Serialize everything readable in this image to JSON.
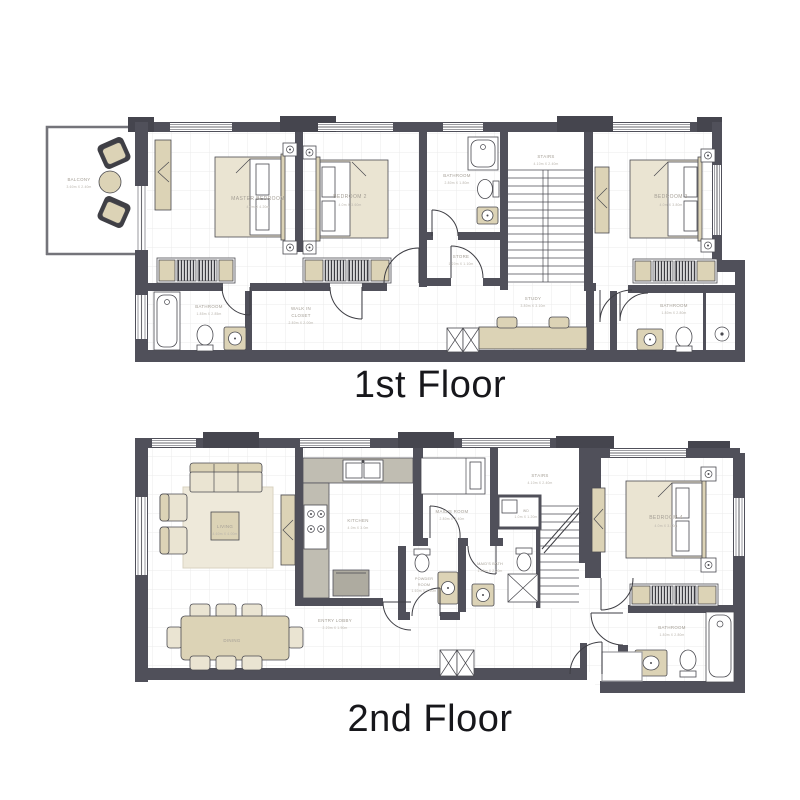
{
  "page": {
    "background": "#ffffff"
  },
  "colors": {
    "wall": "#50505a",
    "furniture_beige": "#dcd3b6",
    "furniture_light": "#eae4d2",
    "counter_gray": "#c0bdb2",
    "grid_line": "#ebebeb",
    "label_text": "#a49e95",
    "title_text": "#17171b"
  },
  "floor1": {
    "title": "1st Floor",
    "rooms": {
      "balcony": {
        "name": "BALCONY",
        "dims": "3.60m X 2.40m"
      },
      "master_bedroom": {
        "name": "MASTER BEDROOM",
        "dims": "4.0m X 4.20m"
      },
      "bedroom2": {
        "name": "BEDROOM 2",
        "dims": "4.0m X 3.60m"
      },
      "bathroom_master": {
        "name": "BATHROOM",
        "dims": "2.80m X 1.80m"
      },
      "stairs": {
        "name": "STAIRS",
        "dims": "4.10m X 2.40m"
      },
      "bedroom3": {
        "name": "BEDROOM 3",
        "dims": "4.0m X 3.80m"
      },
      "store": {
        "name": "STORE",
        "dims": "1.20m X 1.10m"
      },
      "walk_in_closet": {
        "line1": "WALK IN",
        "line2": "CLOSET",
        "dims": "2.80m X 2.00m"
      },
      "bathroom_left": {
        "name": "BATHROOM",
        "dims": "1.85m X 2.85m"
      },
      "study": {
        "name": "STUDY",
        "dims": "3.80m X 3.10m"
      },
      "bathroom_right": {
        "name": "BATHROOM",
        "dims": "1.80m X 2.80m"
      }
    }
  },
  "floor2": {
    "title": "2nd Floor",
    "rooms": {
      "living": {
        "name": "LIVING",
        "dims": "4.60m X 4.00m"
      },
      "kitchen": {
        "name": "KITCHEN",
        "dims": "4.0m X 3.0m"
      },
      "dining": {
        "name": "DINING"
      },
      "entry_lobby": {
        "name": "ENTRY LOBBY",
        "dims": "2.20m X 1.90m"
      },
      "maids_room": {
        "name": "MAID'S ROOM",
        "dims": "2.80m X 2.40m"
      },
      "stairs": {
        "name": "STAIRS",
        "dims": "4.10m X 2.40m"
      },
      "wd": {
        "name": "WD",
        "dims": "1.0m X 1.20m"
      },
      "maids_bath": {
        "name": "MAID'S BATH",
        "dims": "1.80m X 2.20m"
      },
      "powder_room": {
        "line1": "POWDER",
        "line2": "ROOM",
        "dims": "1.60m X 1.50m"
      },
      "bedroom4": {
        "name": "BEDROOM 4",
        "dims": "4.0m X 3.80m"
      },
      "bathroom": {
        "name": "BATHROOM",
        "dims": "1.80m X 2.80m"
      }
    }
  }
}
